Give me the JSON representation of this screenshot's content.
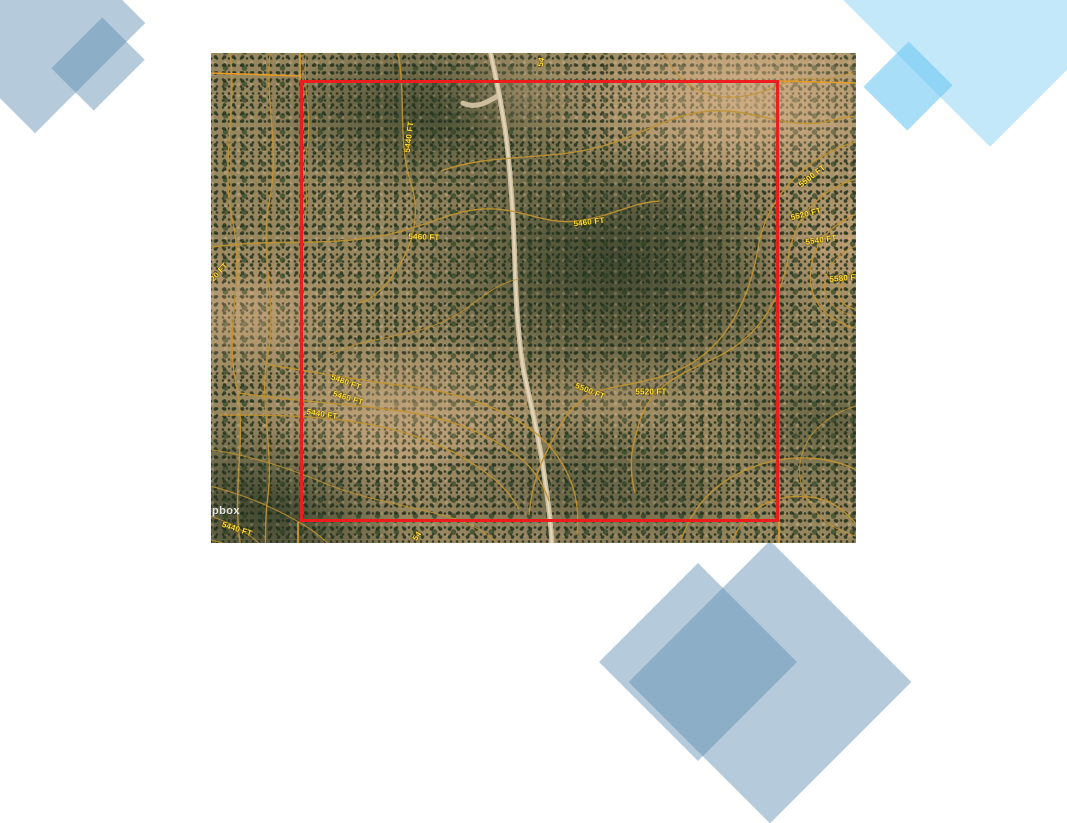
{
  "slide": {
    "background": "#ffffff"
  },
  "decor": {
    "steel_blue": "rgba(90,140,175,0.45)",
    "cyan_large": "rgba(120,205,245,0.45)",
    "cyan_small": "rgba(110,200,243,0.6)"
  },
  "map": {
    "type": "satellite-with-contours",
    "boundary_color": "#ee1d1d",
    "contour_color": "#c09232",
    "section_line_color": "#e89b25",
    "label_color": "#ffdf35",
    "watermark": "pbox",
    "contour_labels": [
      {
        "text": "5440 FT",
        "x": 198,
        "y": 84,
        "rot": -83
      },
      {
        "text": "5460 FT",
        "x": 213,
        "y": 184,
        "rot": 2
      },
      {
        "text": "5460 FT",
        "x": 378,
        "y": 169,
        "rot": -7
      },
      {
        "text": "5500 FT",
        "x": 601,
        "y": 123,
        "rot": -38
      },
      {
        "text": "5520 FT",
        "x": 595,
        "y": 161,
        "rot": -14
      },
      {
        "text": "5540 FT",
        "x": 610,
        "y": 187,
        "rot": -8
      },
      {
        "text": "5580 FT",
        "x": 634,
        "y": 225,
        "rot": -5
      },
      {
        "text": "5480 FT",
        "x": 135,
        "y": 329,
        "rot": 20
      },
      {
        "text": "5460 FT",
        "x": 137,
        "y": 345,
        "rot": 17
      },
      {
        "text": "5440 FT",
        "x": 111,
        "y": 361,
        "rot": 9
      },
      {
        "text": "5500 FT",
        "x": 379,
        "y": 338,
        "rot": 22
      },
      {
        "text": "5520 FT",
        "x": 440,
        "y": 339,
        "rot": 0
      },
      {
        "text": "5440 FT",
        "x": 26,
        "y": 476,
        "rot": 18
      },
      {
        "text": "20 FT",
        "x": 8,
        "y": 219,
        "rot": -48
      },
      {
        "text": "54",
        "x": 330,
        "y": 9,
        "rot": -80
      },
      {
        "text": "54",
        "x": 206,
        "y": 483,
        "rot": -55
      }
    ]
  }
}
